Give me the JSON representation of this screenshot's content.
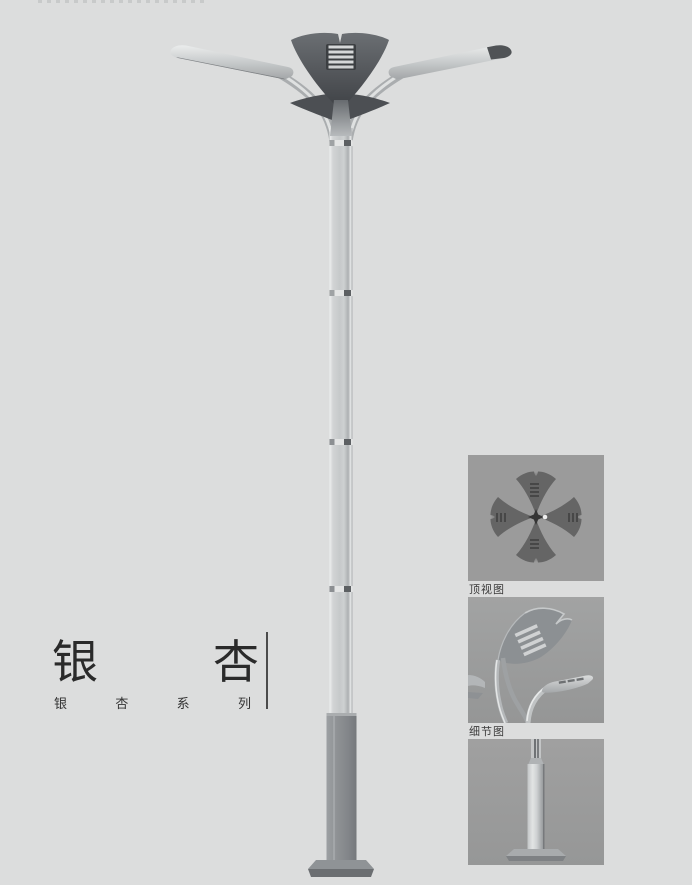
{
  "page": {
    "background": "#dcdddd",
    "description": "Ginkgo series street lamp catalog page"
  },
  "product": {
    "title": "银杏",
    "title_chars": [
      "银",
      "杏"
    ],
    "series_label": "银杏系列",
    "series_chars": [
      "银",
      "杏",
      "系",
      "列"
    ]
  },
  "panels": {
    "top_view": {
      "caption": "顶视图"
    },
    "detail_view": {
      "caption": "细节图"
    },
    "base_view": {
      "caption": ""
    }
  },
  "icons": {
    "streetlight_render": "double-arm ginkgo-leaf street lamp",
    "top_view_image": "four ginkgo leaves in cross layout",
    "detail_view_image": "lamp head close-up",
    "base_view_image": "pole base close-up"
  },
  "colors": {
    "page_background": "#dcdddd",
    "panel_background": "#9b9b9b",
    "fixture_dark": "#4c4f53",
    "pole_light": "#c6c9ca",
    "base_gray": "#8a8d90",
    "text_dark": "#2a2a2a",
    "divider": "#4b4b4b"
  }
}
